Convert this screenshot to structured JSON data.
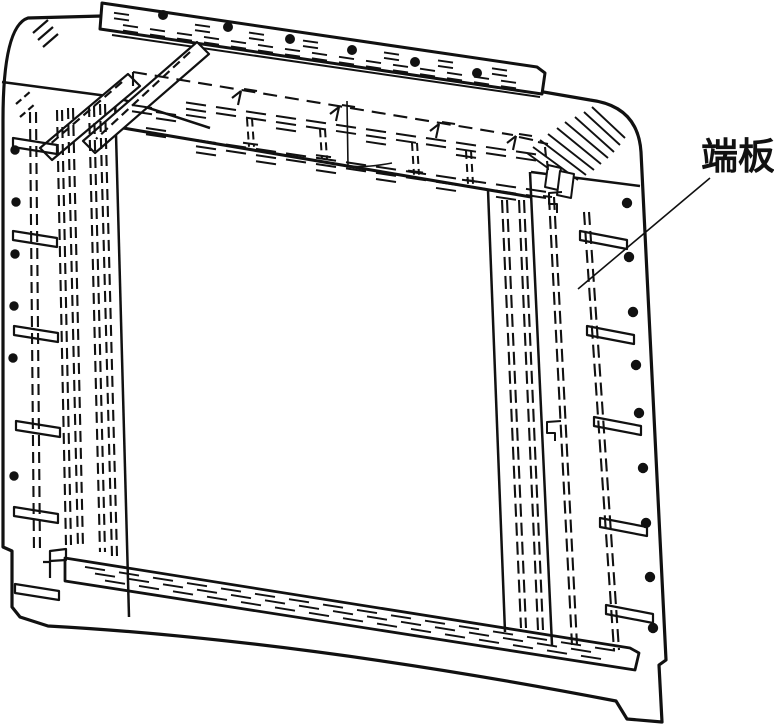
{
  "figure": {
    "label_annotation": {
      "text": "端板"
    },
    "colors": {
      "line": "#111111",
      "background": "#ffffff"
    },
    "rivets": {
      "top_rail": [
        [
          163,
          15
        ],
        [
          228,
          27
        ],
        [
          290,
          39
        ],
        [
          352,
          50
        ],
        [
          415,
          62
        ],
        [
          477,
          73
        ]
      ],
      "left_edge": [
        [
          15,
          150
        ],
        [
          16,
          202
        ],
        [
          15,
          254
        ],
        [
          14,
          306
        ],
        [
          13,
          358
        ],
        [
          14,
          476
        ]
      ],
      "right_edge": [
        [
          627,
          203
        ],
        [
          629,
          257
        ],
        [
          633,
          312
        ],
        [
          636,
          365
        ],
        [
          639,
          413
        ],
        [
          643,
          468
        ],
        [
          646,
          523
        ],
        [
          650,
          577
        ],
        [
          653,
          628
        ]
      ]
    },
    "cleat_tabs": {
      "left": [
        [
          13,
          138
        ],
        [
          13,
          231
        ],
        [
          14,
          326
        ],
        [
          16,
          421
        ],
        [
          14,
          507
        ],
        [
          15,
          584
        ]
      ],
      "right": [
        [
          580,
          231
        ],
        [
          587,
          326
        ],
        [
          594,
          417
        ],
        [
          600,
          518
        ],
        [
          606,
          605
        ]
      ]
    }
  }
}
